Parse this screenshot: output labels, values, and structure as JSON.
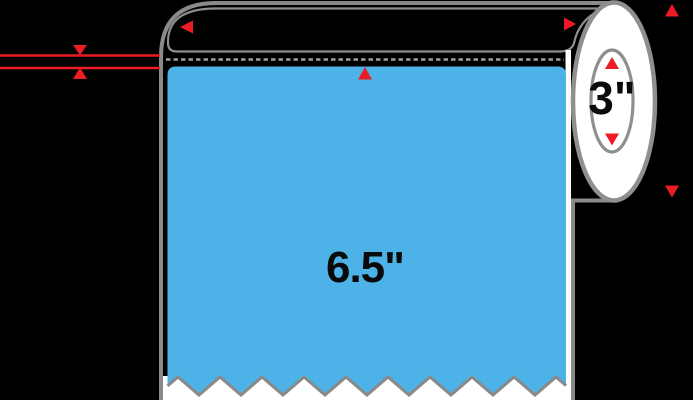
{
  "diagram": {
    "name": "label-roll-dimension-diagram",
    "label_width": "6.5\"",
    "core_diameter": "3\"",
    "colors": {
      "background": "#000000",
      "label_blue": "#4DB2E8",
      "liner_white": "#FFFFFF",
      "outline_gray": "#8A8A8A",
      "arrow_red": "#ED1C24",
      "text_black": "#0A0A0A"
    },
    "arrows": [
      {
        "name": "arrow-left-icon",
        "direction": "left",
        "location": "roll-top-left"
      },
      {
        "name": "arrow-right-icon",
        "direction": "right",
        "location": "roll-top-right"
      },
      {
        "name": "arrow-up-icon",
        "direction": "up",
        "location": "image-top-right"
      },
      {
        "name": "arrow-down-icon",
        "direction": "down",
        "location": "right-of-roll"
      },
      {
        "name": "arrow-up-icon",
        "direction": "up",
        "location": "label-top-center"
      },
      {
        "name": "arrow-up-icon",
        "direction": "up",
        "location": "core-top"
      },
      {
        "name": "arrow-down-icon",
        "direction": "down",
        "location": "core-bottom"
      },
      {
        "name": "arrow-down-icon",
        "direction": "down",
        "location": "left-gap-callout-top"
      },
      {
        "name": "arrow-up-icon",
        "direction": "up",
        "location": "left-gap-callout-bottom"
      }
    ],
    "callout": {
      "name": "liner-gap-callout",
      "lines": 2
    }
  }
}
